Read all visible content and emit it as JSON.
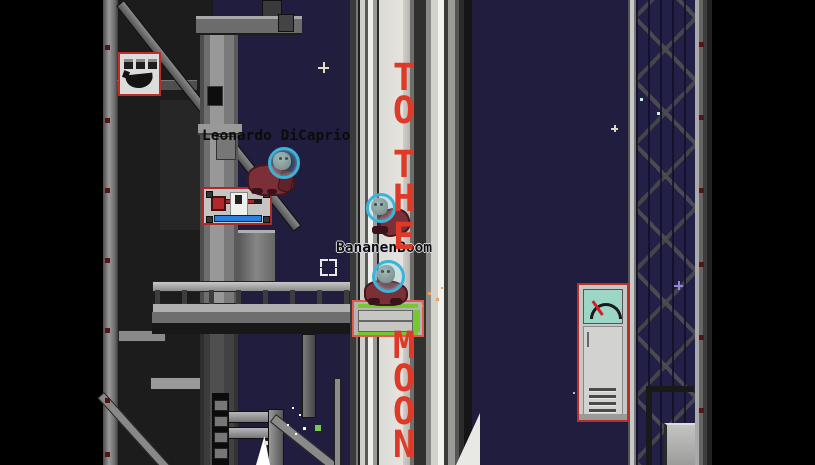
{
  "scene": {
    "background_color": "#201d3f",
    "void_color": "#000000",
    "setting": "pixel-art rocket launch pad at night"
  },
  "players": [
    {
      "label": "Leonardo DiCaprio"
    },
    {
      "label": "BananenBoom"
    }
  ],
  "rocket": {
    "slogan": "TO THE MOON",
    "text_color": "#df3a28",
    "letters": [
      {
        "ch": "T",
        "top": 63
      },
      {
        "ch": "O",
        "top": 96
      },
      {
        "ch": "T",
        "top": 150
      },
      {
        "ch": "H",
        "top": 184
      },
      {
        "ch": "E",
        "top": 222
      },
      {
        "ch": "M",
        "top": 331
      },
      {
        "ch": "O",
        "top": 364
      },
      {
        "ch": "O",
        "top": 397
      },
      {
        "ch": "N",
        "top": 430
      }
    ]
  },
  "machines": {
    "banana_poster": {
      "icon": "banana-icon",
      "border_color": "#b83028"
    },
    "lever_panel": {
      "icon": "lever-icon",
      "border_color": "#b02828",
      "red_bar": "#a82420",
      "blue_bar": "#2a7fe0"
    },
    "progress_panel": {
      "icon": "progress-bars-icon",
      "border_color": "#e05a50",
      "bar_color": "#76c832"
    },
    "gauge_machine": {
      "icon": "gauge-icon",
      "border_color": "#b83028",
      "screen_color": "#9cd6c6",
      "needle_color": "#d42020"
    }
  },
  "stars": [
    {
      "x": 318,
      "y": 62,
      "size": 11,
      "color": "#e8dcc0",
      "type": "plus"
    },
    {
      "x": 611,
      "y": 125,
      "size": 7,
      "color": "#ddd5bc",
      "type": "plus"
    },
    {
      "x": 674,
      "y": 281,
      "size": 9,
      "color": "#8f86d8",
      "type": "plus"
    },
    {
      "x": 640,
      "y": 98,
      "size": 3,
      "color": "#c8f0ea",
      "type": "dot"
    },
    {
      "x": 657,
      "y": 112,
      "size": 3,
      "color": "#c8f0ea",
      "type": "dot"
    },
    {
      "x": 292,
      "y": 407,
      "size": 2,
      "color": "#ffffff",
      "type": "dot"
    },
    {
      "x": 299,
      "y": 414,
      "size": 2,
      "color": "#ffffff",
      "type": "dot"
    },
    {
      "x": 287,
      "y": 424,
      "size": 2,
      "color": "#ffffff",
      "type": "dot"
    },
    {
      "x": 303,
      "y": 427,
      "size": 3,
      "color": "#ffffff",
      "type": "dot"
    },
    {
      "x": 295,
      "y": 433,
      "size": 2,
      "color": "#ffffff",
      "type": "dot"
    },
    {
      "x": 315,
      "y": 425,
      "size": 6,
      "color": "#7ec850",
      "type": "square"
    },
    {
      "x": 573,
      "y": 392,
      "size": 2,
      "color": "#bbbbbb",
      "type": "dot"
    },
    {
      "x": 264,
      "y": 441,
      "size": 4,
      "color": "#f2dcd4",
      "type": "dot"
    },
    {
      "x": 428,
      "y": 292,
      "size": 3,
      "color": "#e8a060",
      "type": "dot"
    },
    {
      "x": 436,
      "y": 298,
      "size": 3,
      "color": "#e8a060",
      "type": "dot"
    },
    {
      "x": 421,
      "y": 305,
      "size": 2,
      "color": "#e8a060",
      "type": "dot"
    },
    {
      "x": 441,
      "y": 287,
      "size": 2,
      "color": "#e8a060",
      "type": "dot"
    }
  ]
}
